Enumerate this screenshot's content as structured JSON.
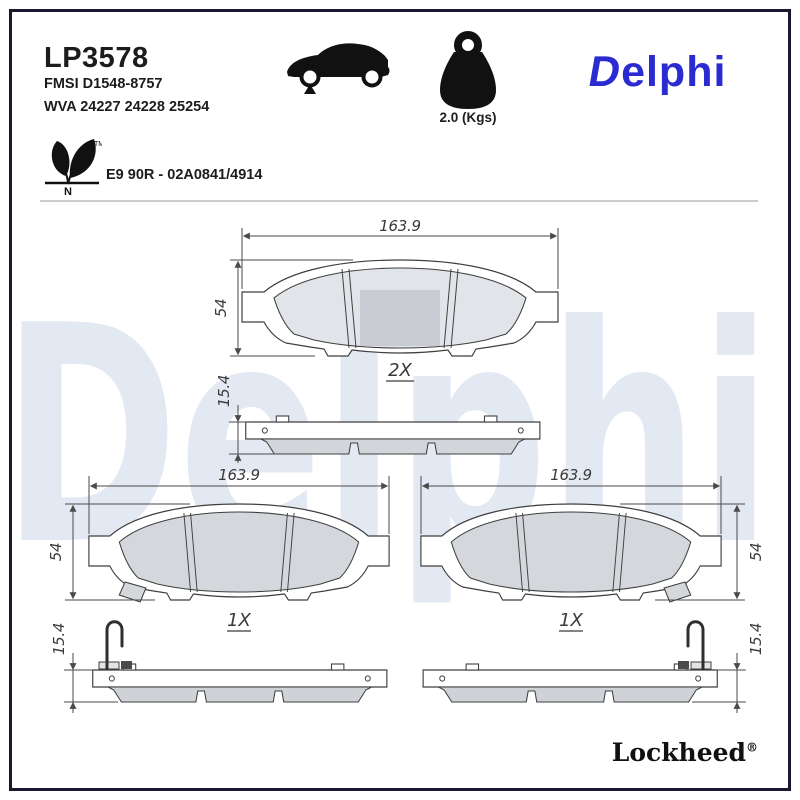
{
  "page": {
    "watermark_text": "Delphi",
    "colors": {
      "brand_blue": "#2b2bd2",
      "watermark": "#e3e9f3",
      "border": "#181830",
      "friction_gray": "#d4d7db",
      "line_gray": "#3f3f3f"
    }
  },
  "header": {
    "part_number": "LP3578",
    "fmsi": "FMSI D1548-8757",
    "wva": "WVA 24227 24228 25254",
    "weight": "2.0 (Kgs)",
    "brand_initial": "D",
    "brand_rest": "elphi",
    "approval": "E9 90R - 02A0841/4914",
    "eco_trademark": "TM",
    "eco_letter": "N"
  },
  "drawings": {
    "top": {
      "qty": "2X",
      "length": "163.9",
      "height": "54",
      "thickness": "15.4"
    },
    "bottom_left": {
      "qty": "1X",
      "length": "163.9",
      "height": "54",
      "thickness": "15.4"
    },
    "bottom_right": {
      "qty": "1X",
      "length": "163.9",
      "height": "54",
      "thickness": "15.4"
    }
  },
  "footer": {
    "sub_brand": "Lockheed",
    "registered": "®"
  }
}
